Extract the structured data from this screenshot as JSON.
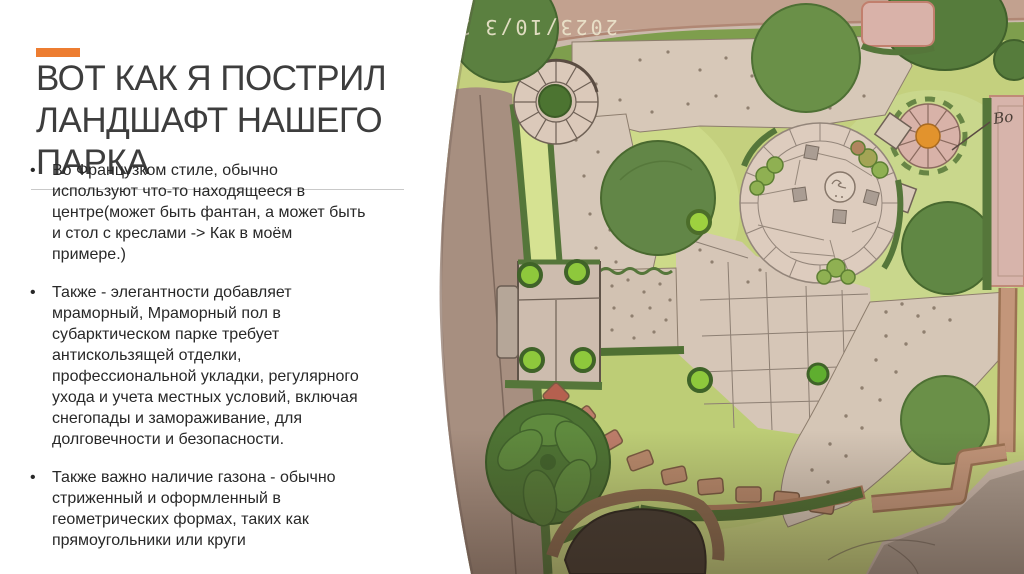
{
  "slide": {
    "accent_color": "#ED7D31",
    "title": "ВОТ КАК Я ПОСТРИЛ ЛАНДШАФТ НАШЕГО ПАРКА",
    "title_lines": [
      "ВОТ КАК Я ПОСТРИЛ",
      "ЛАНДШАФТ НАШЕГО",
      "ПАРКА"
    ],
    "bullets": [
      {
        "marker": "•",
        "lines": [
          "Во Французком стиле, обычно",
          "используют что-то находящееся в",
          "центре(может быть фантан, а может быть",
          "и стол с креслами -> Как в моём",
          "примере.)"
        ]
      },
      {
        "marker": "•",
        "lines": [
          "Также - элегантности добавляет",
          "мраморный, Мраморный пол в",
          "субарктическом парке требует",
          "антискользящей отделки,",
          "профессиональной укладки, регулярного",
          "ухода и учета местных условий, включая",
          "снегопады и замораживание, для",
          "долговечности и безопасности."
        ]
      },
      {
        "marker": "•",
        "lines": [
          "Также важно наличие газона - обычно",
          "стриженный и оформленный в",
          "геометрических формах, таких как",
          "прямоугольники или круги"
        ]
      }
    ]
  },
  "photo": {
    "description": "hand-drawn colored-pencil landscape plan of a park, photographed",
    "date_stamp": "2023/10/3",
    "date_stamp_trailing": "2",
    "date_stamp_orientation": "upside-down",
    "annotation_label": "Во",
    "features": [
      "top-road",
      "left-road",
      "mosaic-circle-with-tree",
      "central-stone-plaza",
      "round-table-with-stools",
      "parasol-with-orange-center",
      "flower-beds",
      "gravel-paths-with-dots",
      "flagstone-paving",
      "bench-court-with-bushes",
      "stepping-stone-path",
      "leafy-plant",
      "pond",
      "lawns",
      "hedges",
      "trees"
    ],
    "colors": {
      "paper": "#cbb9ac",
      "lawn": "#c4d07e",
      "lawn_light": "#d6e292",
      "hedge": "#55763a",
      "tree": "#5b8040",
      "paving": "#d9c8ba",
      "road": "#c2a18f",
      "red_road": "#c3967a",
      "stepping_stone": "#b9886a",
      "pond": "#463c32",
      "parasol_center": "#e2932d",
      "bed_pink": "#d9b2a9",
      "stamp_text": "#ece5cc"
    }
  }
}
